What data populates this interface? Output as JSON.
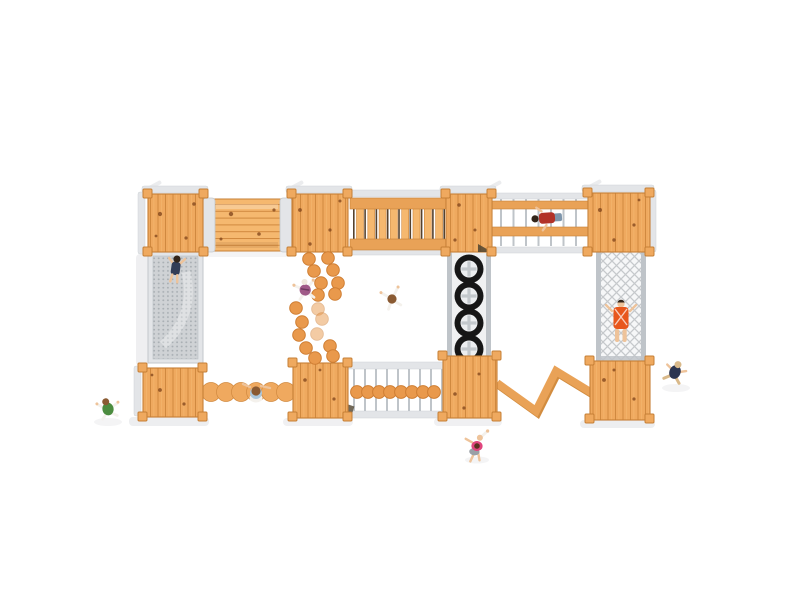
{
  "scene": {
    "label": "timber adventure playground - top view render",
    "colors": {
      "background": "#ffffff",
      "wood_base": "#efa95f",
      "wood_light": "#f5b86f",
      "wood_line": "#d0893f",
      "wood_beam": "#e9a257",
      "wood_beam_shade": "#d28c3f",
      "wood_edge": "#c67f36",
      "knot": "#84491e",
      "metal_light": "#e3e5e8",
      "metal_mid": "#bfc4c9",
      "metal_dark": "#9aa0a6",
      "mesh_base": "#cfd2d5",
      "mesh_dot": "#a8aeb3",
      "net_bg": "#f6f7f8",
      "net_line": "#c6c9cc",
      "anchor_dark": "#4f4430",
      "tire": "#161616",
      "tire_hub": "#eceef0",
      "tire_cross": "#c3c8cc",
      "rope_dark": "#55422e",
      "shadow": "#e9eaec",
      "stone": "#e9994c",
      "stone_rim": "#cf7e33",
      "skin": "#eec39a",
      "hair_dark": "#33251a",
      "hair_brown": "#8a5a32",
      "white_cloth": "#f4f1ec",
      "child_mesh_shirt": "#333d56",
      "child_plum": "#a05a88",
      "child_red": "#b23228",
      "jeans": "#7d95ab",
      "child_orange": "#e8571c",
      "child_navy": "#2c3550",
      "tan": "#d9b98a",
      "child_green": "#4c8c3f",
      "hat_blue": "#abc8de",
      "child_pink": "#e0457d",
      "shorts_gray": "#9aa0a6",
      "head_cap": "#efe8dc"
    },
    "equipment": [
      "platform",
      "log-tunnel-bridge",
      "mesh-climb-ramp",
      "rung-bridge",
      "double-beam-bridge",
      "climbing-net",
      "tire-climber",
      "stepping-stones",
      "disc-bridge",
      "scalloped-balance-log",
      "zigzag-balance-beam"
    ],
    "figures": [
      {
        "name": "child-on-mesh-ramp"
      },
      {
        "name": "child-by-stepping-stones"
      },
      {
        "name": "child-center"
      },
      {
        "name": "child-on-beam-bridge"
      },
      {
        "name": "child-in-climbing-net"
      },
      {
        "name": "child-near-right-platform"
      },
      {
        "name": "child-bottom-left"
      },
      {
        "name": "child-on-balance-log"
      },
      {
        "name": "child-bottom-center"
      }
    ],
    "stones": [
      {
        "x": 309,
        "y": 259
      },
      {
        "x": 328,
        "y": 258
      },
      {
        "x": 314,
        "y": 271
      },
      {
        "x": 333,
        "y": 270
      },
      {
        "x": 321,
        "y": 283
      },
      {
        "x": 338,
        "y": 283
      },
      {
        "x": 318,
        "y": 295
      },
      {
        "x": 335,
        "y": 294
      },
      {
        "x": 296,
        "y": 308
      },
      {
        "x": 318,
        "y": 309,
        "f": 1
      },
      {
        "x": 302,
        "y": 322
      },
      {
        "x": 322,
        "y": 319,
        "f": 1
      },
      {
        "x": 299,
        "y": 335
      },
      {
        "x": 317,
        "y": 334,
        "f": 1
      },
      {
        "x": 306,
        "y": 348
      },
      {
        "x": 330,
        "y": 346
      },
      {
        "x": 315,
        "y": 358
      },
      {
        "x": 333,
        "y": 356
      }
    ],
    "disc_bridge": {
      "y": 392,
      "r": 6.4,
      "xs": [
        357,
        368,
        379,
        390,
        401,
        412,
        423,
        434
      ]
    },
    "tires": {
      "cx": 469,
      "r_outer": 14.5,
      "r_hub": 8.5,
      "cys": [
        269,
        296,
        323,
        349
      ]
    },
    "zigzag_points": "497,383 536,411 556,371 592,393",
    "posts": [
      [
        143,
        189
      ],
      [
        199,
        189
      ],
      [
        143,
        247
      ],
      [
        199,
        247
      ],
      [
        287,
        189
      ],
      [
        343,
        189
      ],
      [
        287,
        247
      ],
      [
        343,
        247
      ],
      [
        441,
        189
      ],
      [
        487,
        189
      ],
      [
        441,
        247
      ],
      [
        487,
        247
      ],
      [
        583,
        188
      ],
      [
        645,
        188
      ],
      [
        583,
        247
      ],
      [
        645,
        247
      ],
      [
        138,
        363
      ],
      [
        198,
        363
      ],
      [
        138,
        412
      ],
      [
        198,
        412
      ],
      [
        288,
        358
      ],
      [
        343,
        358
      ],
      [
        288,
        412
      ],
      [
        343,
        412
      ],
      [
        438,
        351
      ],
      [
        492,
        351
      ],
      [
        438,
        412
      ],
      [
        492,
        412
      ],
      [
        585,
        356
      ],
      [
        645,
        356
      ],
      [
        585,
        414
      ],
      [
        645,
        414
      ]
    ],
    "rung_bridge": {
      "slat_x0": 356.5,
      "slat_step": 11.3,
      "slat_count": 8,
      "slat_w": 7,
      "slat_y": 204,
      "slat_h": 42,
      "rope_x0": 353,
      "rope_step": 11.3,
      "rope_count": 9
    },
    "beam_bridge": {
      "rung_x0": 500,
      "rung_step": 12.5,
      "rung_count": 7,
      "rung_y": 199,
      "rung_h": 47
    },
    "disc_rods": {
      "x0": 353,
      "step": 11,
      "count": 9,
      "y": 369,
      "h": 42
    },
    "log_scallops": [
      211,
      226,
      241,
      256,
      271,
      286
    ],
    "knots": [
      [
        160,
        214,
        2.1
      ],
      [
        186,
        238,
        1.6
      ],
      [
        194,
        204,
        1.8
      ],
      [
        156,
        236,
        1.4
      ],
      [
        300,
        210,
        1.9
      ],
      [
        330,
        230,
        1.6
      ],
      [
        340,
        201,
        1.5
      ],
      [
        310,
        244,
        1.7
      ],
      [
        600,
        210,
        2.0
      ],
      [
        634,
        225,
        1.6
      ],
      [
        614,
        240,
        1.7
      ],
      [
        639,
        200,
        1.4
      ],
      [
        459,
        205,
        1.8
      ],
      [
        475,
        230,
        1.5
      ],
      [
        455,
        240,
        1.6
      ],
      [
        160,
        390,
        1.9
      ],
      [
        184,
        404,
        1.6
      ],
      [
        152,
        375,
        1.4
      ],
      [
        305,
        380,
        1.8
      ],
      [
        334,
        399,
        1.6
      ],
      [
        320,
        370,
        1.4
      ],
      [
        455,
        394,
        1.8
      ],
      [
        479,
        374,
        1.5
      ],
      [
        464,
        408,
        1.6
      ],
      [
        604,
        380,
        1.9
      ],
      [
        634,
        399,
        1.6
      ],
      [
        614,
        370,
        1.5
      ],
      [
        231,
        214,
        2.2
      ],
      [
        259,
        234,
        1.8
      ],
      [
        274,
        210,
        1.6
      ],
      [
        221,
        239,
        1.5
      ]
    ]
  }
}
